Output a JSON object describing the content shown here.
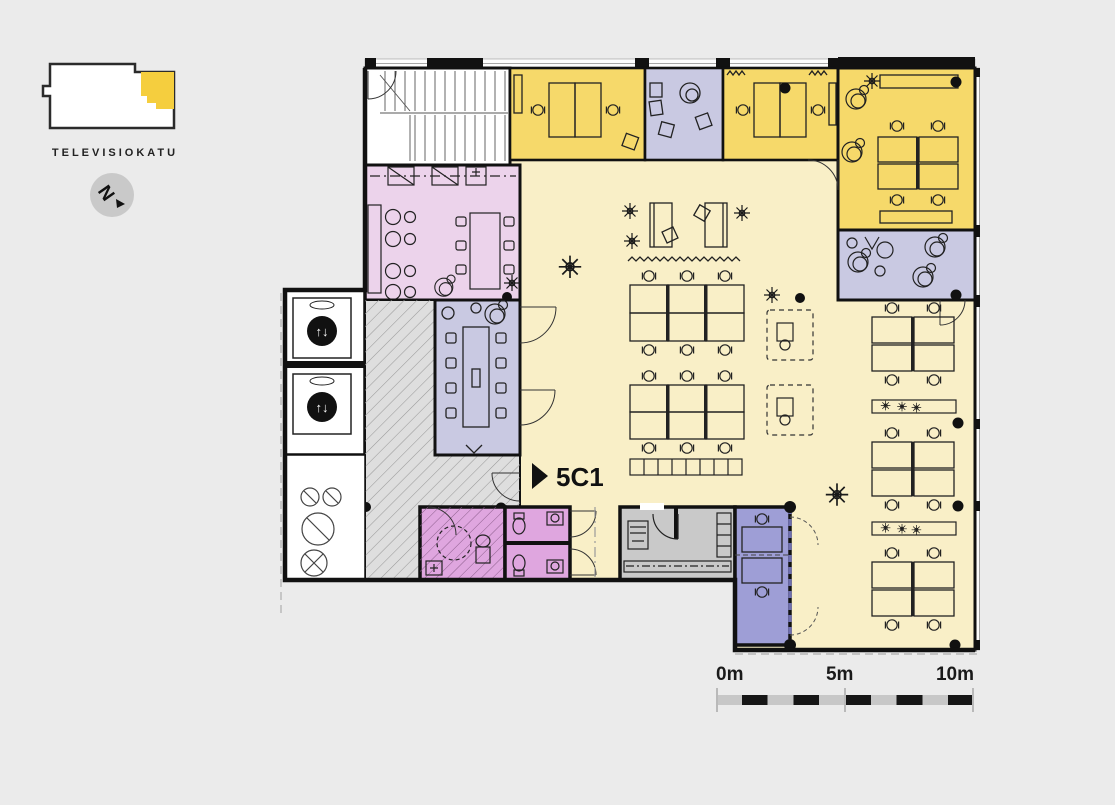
{
  "key_plan": {
    "street_label": "TELEVISIOKATU",
    "highlight_color": "#f5ce3e"
  },
  "compass": {
    "letter": "N",
    "icon": "north-arrow-icon"
  },
  "unit": {
    "label": "5C1",
    "marker_icon": "triangle-right-icon"
  },
  "elevator": {
    "icon_glyph": "↑↓",
    "icon": "elevator-updown-icon"
  },
  "scale_bar": {
    "labels": [
      "0m",
      "5m",
      "10m"
    ]
  },
  "colors": {
    "background": "#ebebeb",
    "open_space": "#f9efc7",
    "office_yellow": "#f6d96a",
    "lounge_lavender": "#c9c9e2",
    "cafe_pink": "#ecd3eb",
    "wc_pink": "#dfa6df",
    "team_purple": "#9e9ed6",
    "corridor_gray": "#dedede",
    "utility_gray": "#c9c9c9",
    "window_band": "#fdfdfd",
    "wall": "#111111"
  }
}
